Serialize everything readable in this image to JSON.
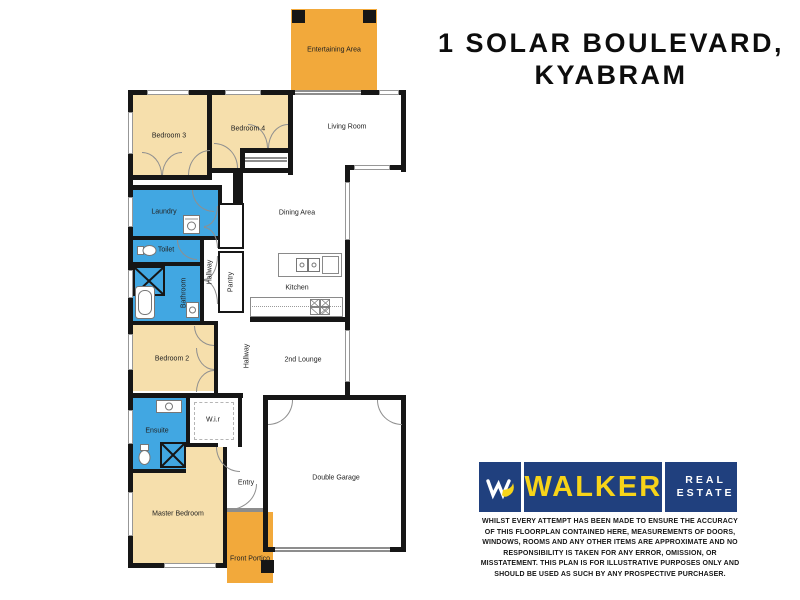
{
  "title": {
    "line1": "1 SOLAR BOULEVARD,",
    "line2": "KYABRAM"
  },
  "floorplan": {
    "rooms": {
      "entertaining": "Entertaining Area",
      "bedroom3": "Bedroom 3",
      "bedroom4": "Bedroom 4",
      "living": "Living Room",
      "laundry": "Laundry",
      "toilet": "Toilet",
      "bathroom": "Bathroom",
      "hallway1": "Hallway",
      "pantry": "Pantry",
      "dining": "Dining Area",
      "kitchen": "Kitchen",
      "bedroom2": "Bedroom 2",
      "hallway2": "Hallway",
      "lounge2": "2nd Lounge",
      "ensuite": "Ensuite",
      "wir": "W.i.r",
      "master": "Master Bedroom",
      "entry": "Entry",
      "garage": "Double Garage",
      "portico": "Front Portico"
    }
  },
  "logo": {
    "brand": "WALKER",
    "real": "REAL",
    "estate": "ESTATE"
  },
  "disclaimer": "WHILST EVERY ATTEMPT HAS BEEN MADE TO ENSURE THE ACCURACY OF THIS FLOORPLAN CONTAINED HERE, MEASUREMENTS OF DOORS, WINDOWS, ROOMS AND ANY OTHER ITEMS ARE APPROXIMATE AND NO RESPONSIBILITY IS TAKEN FOR ANY ERROR, OMISSION, OR MISSTATEMENT. THIS PLAN IS FOR ILLUSTRATIVE PURPOSES ONLY AND SHOULD BE USED AS SUCH BY ANY PROSPECTIVE PURCHASER.",
  "colors": {
    "outdoor": "#F2A93B",
    "bedroom": "#F6DFAC",
    "wet": "#41A7E2",
    "wall": "#161616",
    "logoBlue": "#20407E",
    "logoYellow": "#F7D419"
  }
}
